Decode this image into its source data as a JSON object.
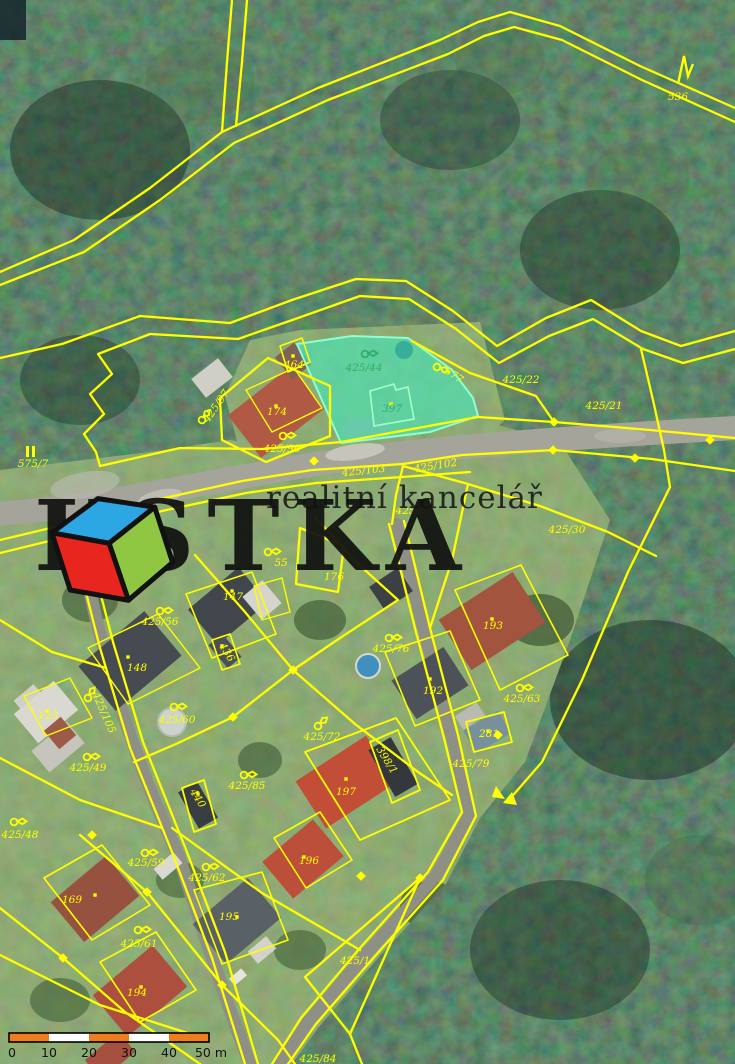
{
  "map": {
    "line_color": "#ffff00",
    "highlight": {
      "parcel": "425/44",
      "building": "397",
      "fill": "#40ebbe",
      "label_color": "#2fae68"
    },
    "labels": [
      {
        "text": "536",
        "x": 678,
        "y": 100
      },
      {
        "text": "575/7",
        "x": 33,
        "y": 467
      },
      {
        "text": "425/22",
        "x": 521,
        "y": 383
      },
      {
        "text": "425/21",
        "x": 604,
        "y": 409
      },
      {
        "text": "677",
        "x": 452,
        "y": 378,
        "rot": 33
      },
      {
        "text": "425/97",
        "x": 219,
        "y": 408,
        "rot": -55
      },
      {
        "text": "464",
        "x": 294,
        "y": 368
      },
      {
        "text": "174",
        "x": 277,
        "y": 415
      },
      {
        "text": "425/96",
        "x": 282,
        "y": 452
      },
      {
        "text": "425/103",
        "x": 364,
        "y": 474,
        "rot": -6
      },
      {
        "text": "425/102",
        "x": 436,
        "y": 469,
        "rot": -9
      },
      {
        "text": "425/64",
        "x": 414,
        "y": 514
      },
      {
        "text": "425/30",
        "x": 567,
        "y": 533
      },
      {
        "text": "176",
        "x": 334,
        "y": 580
      },
      {
        "text": "55",
        "x": 281,
        "y": 566
      },
      {
        "text": "425/56",
        "x": 160,
        "y": 625
      },
      {
        "text": "147",
        "x": 233,
        "y": 600
      },
      {
        "text": "436",
        "x": 224,
        "y": 654,
        "rot": 58
      },
      {
        "text": "148",
        "x": 137,
        "y": 671
      },
      {
        "text": "123",
        "x": 48,
        "y": 719
      },
      {
        "text": "425/105",
        "x": 101,
        "y": 714,
        "rot": 66
      },
      {
        "text": "425/60",
        "x": 177,
        "y": 723
      },
      {
        "text": "425/49",
        "x": 88,
        "y": 771
      },
      {
        "text": "425/48",
        "x": 20,
        "y": 838
      },
      {
        "text": "425/85",
        "x": 247,
        "y": 789
      },
      {
        "text": "425/76",
        "x": 391,
        "y": 652
      },
      {
        "text": "193",
        "x": 493,
        "y": 629
      },
      {
        "text": "192",
        "x": 433,
        "y": 694
      },
      {
        "text": "425/63",
        "x": 522,
        "y": 702
      },
      {
        "text": "425/72",
        "x": 322,
        "y": 740
      },
      {
        "text": "281",
        "x": 489,
        "y": 737
      },
      {
        "text": "425/79",
        "x": 471,
        "y": 767
      },
      {
        "text": "197",
        "x": 346,
        "y": 795
      },
      {
        "text": "398/1",
        "x": 384,
        "y": 762,
        "rot": 58
      },
      {
        "text": "425/59",
        "x": 146,
        "y": 866
      },
      {
        "text": "425/62",
        "x": 207,
        "y": 881
      },
      {
        "text": "169",
        "x": 72,
        "y": 903
      },
      {
        "text": "196",
        "x": 309,
        "y": 864
      },
      {
        "text": "195",
        "x": 229,
        "y": 920
      },
      {
        "text": "425/61",
        "x": 139,
        "y": 947
      },
      {
        "text": "194",
        "x": 137,
        "y": 996
      },
      {
        "text": "440",
        "x": 195,
        "y": 800,
        "rot": 58
      },
      {
        "text": "425/1",
        "x": 355,
        "y": 964
      },
      {
        "text": "425/84",
        "x": 318,
        "y": 1062
      },
      {
        "text": "425/44",
        "x": 364,
        "y": 371,
        "color": "#2fae68"
      },
      {
        "text": "397",
        "x": 392,
        "y": 412,
        "color": "#2fae68"
      }
    ],
    "symbols": [
      {
        "type": "pennant",
        "x": 437,
        "y": 367,
        "rot": 25
      },
      {
        "type": "pennant",
        "x": 283,
        "y": 436
      },
      {
        "type": "pennant",
        "x": 202,
        "y": 420,
        "rot": -50
      },
      {
        "type": "pennant",
        "x": 268,
        "y": 552
      },
      {
        "type": "pennant",
        "x": 160,
        "y": 611
      },
      {
        "type": "pennant",
        "x": 88,
        "y": 698,
        "rot": -55
      },
      {
        "type": "pennant",
        "x": 174,
        "y": 707
      },
      {
        "type": "pennant",
        "x": 87,
        "y": 757
      },
      {
        "type": "pennant",
        "x": 14,
        "y": 822
      },
      {
        "type": "pennant",
        "x": 244,
        "y": 775
      },
      {
        "type": "pennant",
        "x": 389,
        "y": 638
      },
      {
        "type": "pennant",
        "x": 520,
        "y": 688
      },
      {
        "type": "pennant",
        "x": 318,
        "y": 726,
        "rot": -40
      },
      {
        "type": "pennant",
        "x": 145,
        "y": 853
      },
      {
        "type": "pennant",
        "x": 206,
        "y": 867
      },
      {
        "type": "pennant",
        "x": 138,
        "y": 930
      },
      {
        "type": "pennant",
        "x": 365,
        "y": 354,
        "color": "#2fae68"
      },
      {
        "type": "meadow-bars",
        "x": 31,
        "y": 451
      },
      {
        "type": "conifer",
        "x": 684,
        "y": 68
      }
    ]
  },
  "watermark": {
    "line1": "realitní kancelář",
    "brand_prefix": "K",
    "brand_suffix": "STKA",
    "cube_colors": {
      "top": "#2ca7e4",
      "left": "#e8251f",
      "right": "#8fc742"
    }
  },
  "scalebar": {
    "ticks": [
      "0",
      "10",
      "20",
      "30",
      "40",
      "50 m"
    ],
    "segment_colors": [
      "#ee7d20",
      "#ffffff"
    ]
  }
}
